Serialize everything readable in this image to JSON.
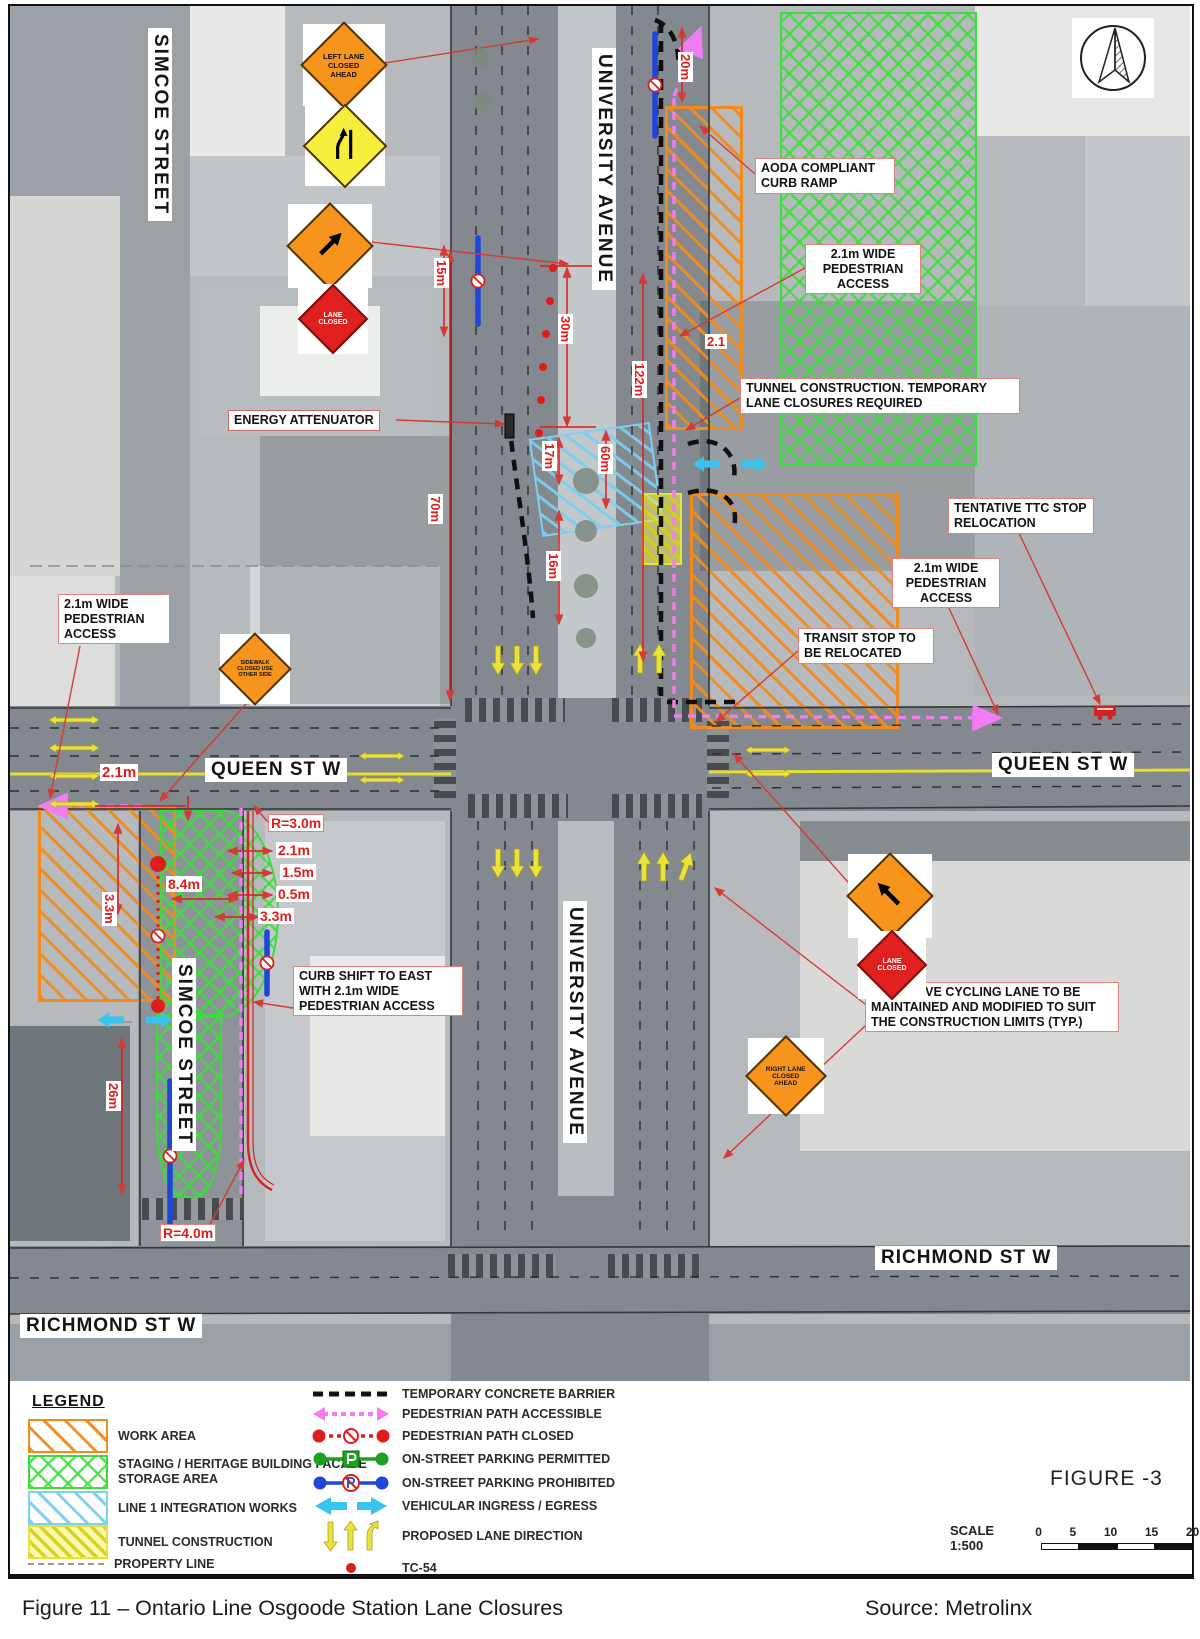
{
  "streets": {
    "simcoe_top": "SIMCOE STREET",
    "simcoe_bottom": "SIMCOE STREET",
    "university_top": "UNIVERSITY AVENUE",
    "university_bottom": "UNIVERSITY AVENUE",
    "queen_left": "QUEEN ST W",
    "queen_right": "QUEEN ST W",
    "richmond_left": "RICHMOND ST W",
    "richmond_right": "RICHMOND ST W"
  },
  "signs": {
    "left_lane_closed_ahead": "LEFT LANE CLOSED AHEAD",
    "lane_closed_west": "LANE CLOSED",
    "sidewalk_closed": "SIDEWALK CLOSED USE OTHER SIDE",
    "lane_closed_east": "LANE CLOSED",
    "right_lane_closed_ahead": "RIGHT LANE CLOSED AHEAD"
  },
  "annotations": {
    "aoda_curb_ramp": "AODA COMPLIANT CURB RAMP",
    "ped_access_ne": "2.1m WIDE PEDESTRIAN ACCESS",
    "tunnel_construction": "TUNNEL CONSTRUCTION. TEMPORARY LANE CLOSURES REQUIRED",
    "ttc_stop_relocation": "TENTATIVE TTC STOP RELOCATION",
    "ped_access_east": "2.1m WIDE PEDESTRIAN ACCESS",
    "transit_stop_relocated": "TRANSIT STOP TO BE RELOCATED",
    "energy_attenuator": "ENERGY ATTENUATOR",
    "ped_access_west": "2.1m WIDE PEDESTRIAN ACCESS",
    "curb_shift": "CURB SHIFT TO EAST WITH 2.1m WIDE PEDESTRIAN ACCESS",
    "cycling_lane": "EXCLUSIVE CYCLING LANE TO BE MAINTAINED AND MODIFIED TO SUIT THE CONSTRUCTION LIMITS (TYP.)"
  },
  "dimensions": {
    "d20m": "20m",
    "d15m": "15m",
    "d30m": "30m",
    "d122m": "122m",
    "d2_1": "2.1",
    "d17m": "17m",
    "d60m": "60m",
    "d16m": "16m",
    "d70m": "70m",
    "queen_2_1m": "2.1m",
    "r3": "R=3.0m",
    "c2_1m": "2.1m",
    "c1_5m": "1.5m",
    "c0_5m": "0.5m",
    "c3_3m": "3.3m",
    "v3_3m": "3.3m",
    "d8_4m": "8.4m",
    "d26m": "26m",
    "r4": "R=4.0m"
  },
  "legend": {
    "title": "LEGEND",
    "areas": [
      {
        "label": "WORK AREA"
      },
      {
        "label": "STAGING / HERITAGE BUILDING FACADE STORAGE AREA"
      },
      {
        "label": "LINE 1 INTEGRATION WORKS"
      },
      {
        "label": "TUNNEL CONSTRUCTION"
      },
      {
        "label": "PROPERTY LINE"
      }
    ],
    "lines": [
      {
        "label": "TEMPORARY CONCRETE BARRIER"
      },
      {
        "label": "PEDESTRIAN PATH ACCESSIBLE"
      },
      {
        "label": "PEDESTRIAN PATH CLOSED"
      },
      {
        "label": "ON-STREET PARKING PERMITTED"
      },
      {
        "label": "ON-STREET PARKING PROHIBITED"
      },
      {
        "label": "VEHICULAR INGRESS / EGRESS"
      },
      {
        "label": "PROPOSED LANE DIRECTION"
      },
      {
        "label": "TC-54"
      }
    ]
  },
  "figure": {
    "number": "FIGURE -3",
    "scale_label": "SCALE 1:500",
    "ticks": [
      "0",
      "5",
      "10",
      "15",
      "20"
    ]
  },
  "caption": {
    "title": "Figure 11 – Ontario Line Osgoode Station Lane Closures",
    "source": "Source: Metrolinx"
  },
  "colors": {
    "work_area": "#f08c1e",
    "staging": "#3cdc3c",
    "line1_integration": "#7fd0ef",
    "tunnel": "#f0ec3c",
    "ped_accessible": "#f27df2",
    "ped_closed": "#e01b1b",
    "parking_permitted": "#1fa11f",
    "parking_prohibited": "#1f46d8",
    "ingress_egress": "#38c4ee",
    "lane_direction": "#ece23c",
    "dimension_red": "#e01b1b"
  }
}
